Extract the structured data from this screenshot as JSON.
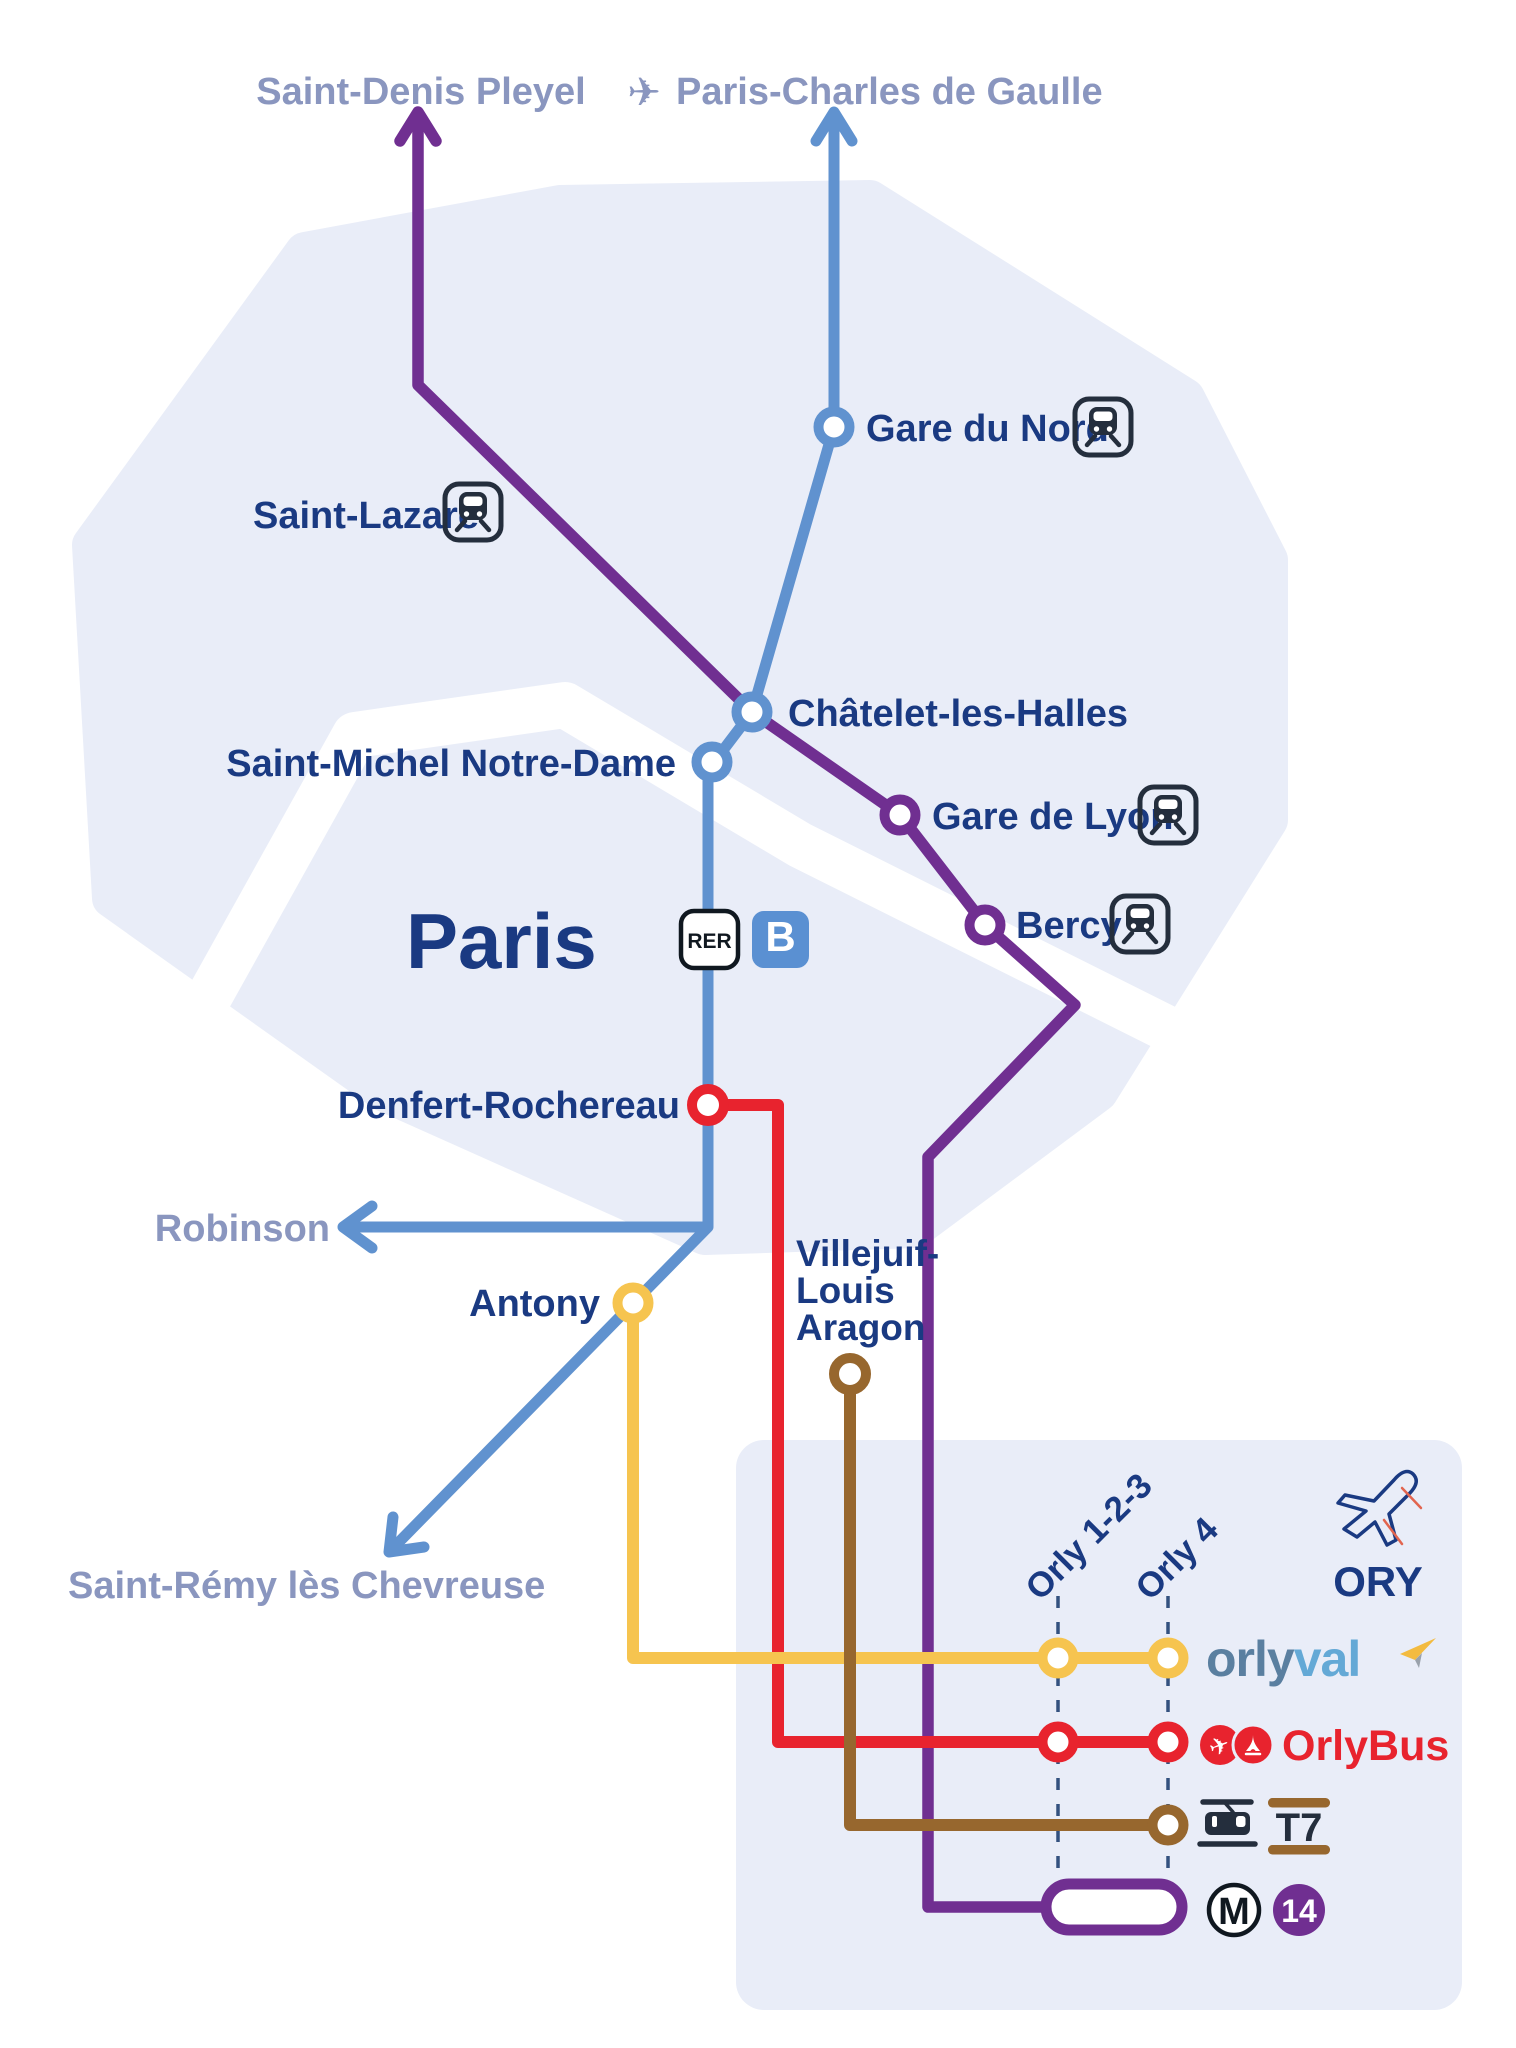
{
  "colors": {
    "rer_b": "#6092cf",
    "m14": "#702f91",
    "orlybus_red": "#e8232e",
    "orlyval_yellow": "#f6c44f",
    "t7_brown": "#97672e",
    "region_fill": "#e9edf8",
    "navy_text": "#1a3a82",
    "muted_text": "#8a96bf",
    "icon_dark": "#242e3d"
  },
  "icons": {
    "plane_glyph": "✈"
  },
  "termini": {
    "saint_denis_pleyel": "Saint-Denis Pleyel",
    "paris_cdg": "Paris-Charles de Gaulle",
    "robinson": "Robinson",
    "saint_remy": "Saint-Rémy lès Chevreuse"
  },
  "stations": {
    "gare_du_nord": "Gare du Nord",
    "saint_lazare": "Saint-Lazare",
    "chatelet": "Châtelet-les-Halles",
    "saint_michel": "Saint-Michel Notre-Dame",
    "gare_de_lyon": "Gare de Lyon",
    "bercy": "Bercy",
    "denfert": "Denfert-Rochereau",
    "antony": "Antony",
    "villejuif_line1": "Villejuif-",
    "villejuif_line2": "Louis",
    "villejuif_line3": "Aragon"
  },
  "region_label": "Paris",
  "badges": {
    "rer": "RER",
    "rer_line": "B",
    "metro": "M",
    "metro_line": "14",
    "tram_line": "T7"
  },
  "airport": {
    "code": "ORY",
    "terminal_1": "Orly 1-2-3",
    "terminal_2": "Orly 4"
  },
  "brands": {
    "orlyval_part1": "orly",
    "orlyval_part2": "val",
    "orlybus": "OrlyBus"
  }
}
